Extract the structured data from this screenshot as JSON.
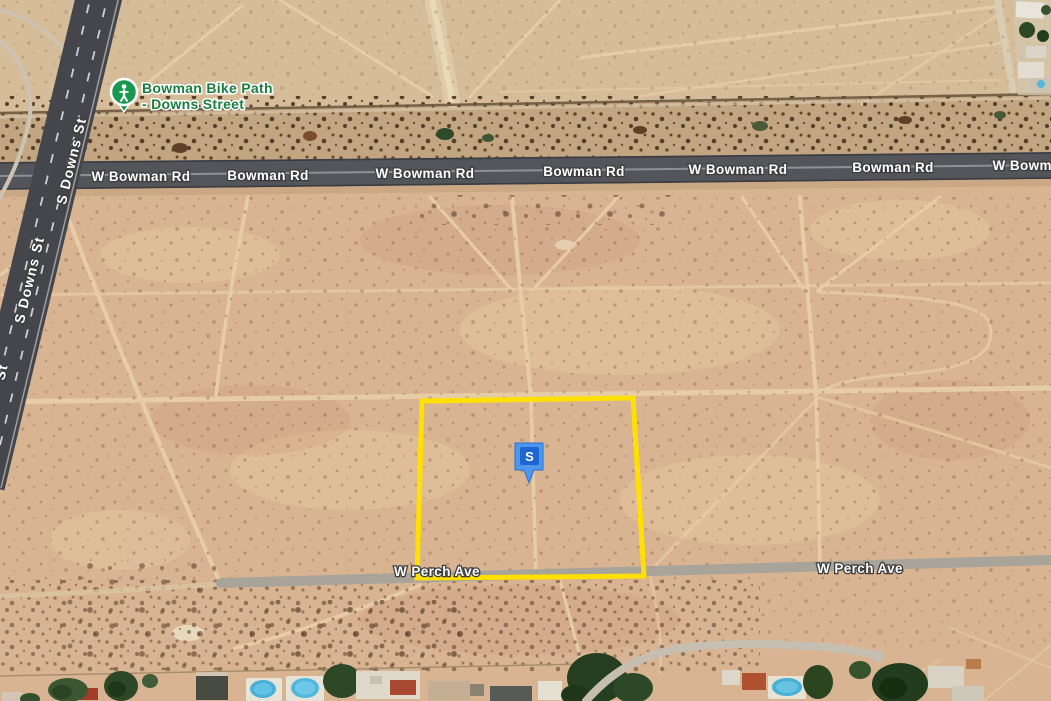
{
  "labels": {
    "bowman": [
      {
        "text": "W Bowman Rd"
      },
      {
        "text": "Bowman Rd"
      },
      {
        "text": "W Bowman Rd"
      },
      {
        "text": "Bowman Rd"
      },
      {
        "text": "W Bowman Rd"
      },
      {
        "text": "Bowman Rd"
      },
      {
        "text": "W Bowman Rd"
      }
    ],
    "downs": [
      {
        "text": "S Downs St"
      },
      {
        "text": "S Downs St"
      },
      {
        "text": "St"
      }
    ],
    "perch": [
      {
        "text": "W Perch Ave"
      },
      {
        "text": "W Perch Ave"
      }
    ],
    "bike_path": {
      "line1": "Bowman Bike Path",
      "line2": "- Downs Street"
    }
  },
  "marker": {
    "letter": "S"
  },
  "colors": {
    "parcel_outline": "#ffe000",
    "marker_fill": "#4f97ee",
    "marker_inner": "#1b66d2",
    "transit_green": "#18994f",
    "label_green": "#1a7e3e"
  }
}
